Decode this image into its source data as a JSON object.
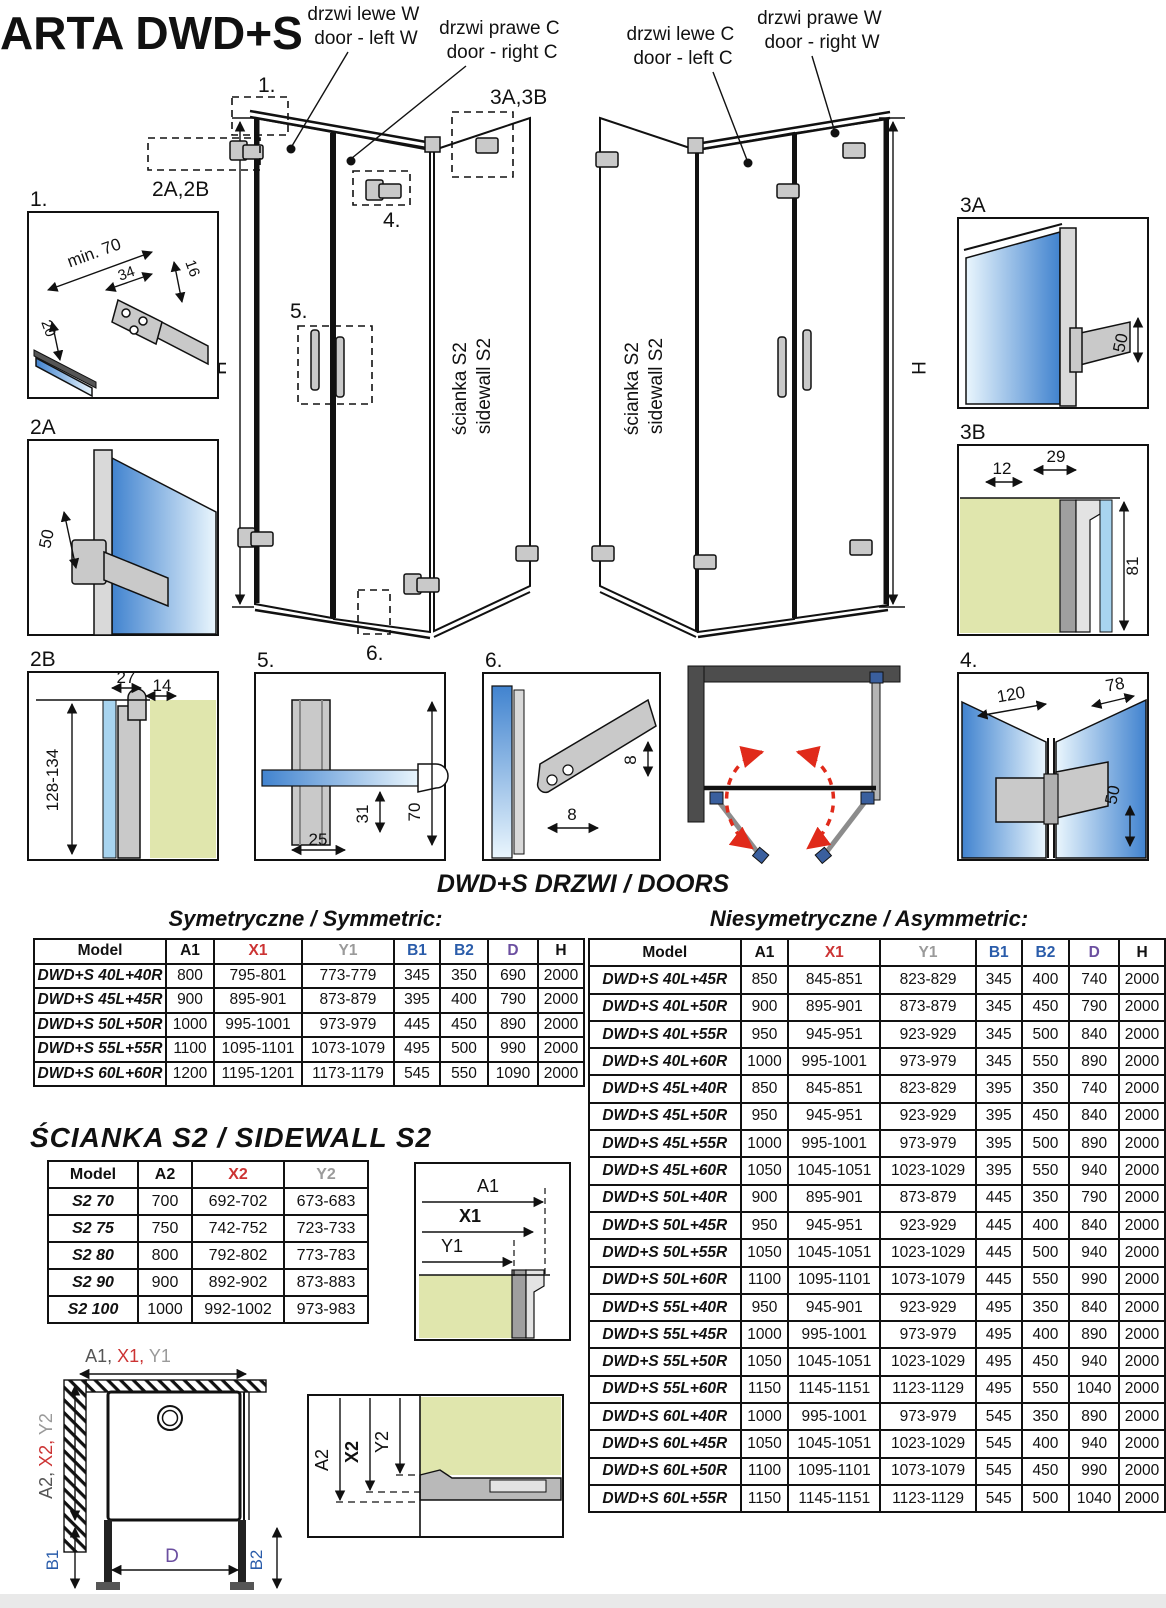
{
  "header": {
    "title": "ARTA DWD+S"
  },
  "units": {
    "left": {
      "door_l1": "drzwi lewe W",
      "door_l2": "door - left W",
      "door_r1": "drzwi prawe C",
      "door_r2": "door - right C",
      "wall1": "ścianka S2",
      "wall2": "sidewall S2",
      "h": "H"
    },
    "right": {
      "door_l1": "drzwi lewe C",
      "door_l2": "door - left C",
      "door_r1": "drzwi prawe W",
      "door_r2": "door - right W",
      "wall1": "ścianka S2",
      "wall2": "sidewall S2",
      "h": "H"
    }
  },
  "callouts": {
    "c1": "1.",
    "c2": "2A,2B",
    "c3": "3A,3B",
    "c4": "4.",
    "c5": "5.",
    "c6": "6."
  },
  "details": {
    "d1": {
      "label": "1.",
      "min70": "min. 70",
      "d34": "34",
      "d16": "16",
      "d20": "20"
    },
    "d2a": {
      "label": "2A",
      "d50": "50"
    },
    "d2b": {
      "label": "2B",
      "d27": "27",
      "d14": "14",
      "range": "128-134"
    },
    "d3a": {
      "label": "3A",
      "d50": "50"
    },
    "d3b": {
      "label": "3B",
      "d12": "12",
      "d29": "29",
      "d81": "81"
    },
    "d4": {
      "label": "4.",
      "d120": "120",
      "d78": "78",
      "d50": "50"
    },
    "d5": {
      "label": "5.",
      "d31": "31",
      "d25": "25",
      "d70": "70"
    },
    "d6": {
      "label": "6.",
      "d8a": "8",
      "d8b": "8"
    }
  },
  "tables": {
    "doors_title": "DWD+S DRZWI / DOORS",
    "symmetric": {
      "title": "Symetryczne / Symmetric:",
      "headers": [
        "Model",
        "A1",
        "X1",
        "Y1",
        "B1",
        "B2",
        "D",
        "H"
      ],
      "header_colors": [
        "#111",
        "#111",
        "#cc3333",
        "#9a9a9a",
        "#2a5caa",
        "#2a5caa",
        "#6b4fa0",
        "#111"
      ],
      "rows": [
        [
          "DWD+S 40L+40R",
          "800",
          "795-801",
          "773-779",
          "345",
          "350",
          "690",
          "2000"
        ],
        [
          "DWD+S 45L+45R",
          "900",
          "895-901",
          "873-879",
          "395",
          "400",
          "790",
          "2000"
        ],
        [
          "DWD+S 50L+50R",
          "1000",
          "995-1001",
          "973-979",
          "445",
          "450",
          "890",
          "2000"
        ],
        [
          "DWD+S 55L+55R",
          "1100",
          "1095-1101",
          "1073-1079",
          "495",
          "500",
          "990",
          "2000"
        ],
        [
          "DWD+S 60L+60R",
          "1200",
          "1195-1201",
          "1173-1179",
          "545",
          "550",
          "1090",
          "2000"
        ]
      ]
    },
    "asymmetric": {
      "title": "Niesymetryczne / Asymmetric:",
      "headers": [
        "Model",
        "A1",
        "X1",
        "Y1",
        "B1",
        "B2",
        "D",
        "H"
      ],
      "header_colors": [
        "#111",
        "#111",
        "#cc3333",
        "#9a9a9a",
        "#2a5caa",
        "#2a5caa",
        "#6b4fa0",
        "#111"
      ],
      "rows": [
        [
          "DWD+S 40L+45R",
          "850",
          "845-851",
          "823-829",
          "345",
          "400",
          "740",
          "2000"
        ],
        [
          "DWD+S 40L+50R",
          "900",
          "895-901",
          "873-879",
          "345",
          "450",
          "790",
          "2000"
        ],
        [
          "DWD+S 40L+55R",
          "950",
          "945-951",
          "923-929",
          "345",
          "500",
          "840",
          "2000"
        ],
        [
          "DWD+S 40L+60R",
          "1000",
          "995-1001",
          "973-979",
          "345",
          "550",
          "890",
          "2000"
        ],
        [
          "DWD+S 45L+40R",
          "850",
          "845-851",
          "823-829",
          "395",
          "350",
          "740",
          "2000"
        ],
        [
          "DWD+S 45L+50R",
          "950",
          "945-951",
          "923-929",
          "395",
          "450",
          "840",
          "2000"
        ],
        [
          "DWD+S 45L+55R",
          "1000",
          "995-1001",
          "973-979",
          "395",
          "500",
          "890",
          "2000"
        ],
        [
          "DWD+S 45L+60R",
          "1050",
          "1045-1051",
          "1023-1029",
          "395",
          "550",
          "940",
          "2000"
        ],
        [
          "DWD+S 50L+40R",
          "900",
          "895-901",
          "873-879",
          "445",
          "350",
          "790",
          "2000"
        ],
        [
          "DWD+S 50L+45R",
          "950",
          "945-951",
          "923-929",
          "445",
          "400",
          "840",
          "2000"
        ],
        [
          "DWD+S 50L+55R",
          "1050",
          "1045-1051",
          "1023-1029",
          "445",
          "500",
          "940",
          "2000"
        ],
        [
          "DWD+S 50L+60R",
          "1100",
          "1095-1101",
          "1073-1079",
          "445",
          "550",
          "990",
          "2000"
        ],
        [
          "DWD+S 55L+40R",
          "950",
          "945-901",
          "923-929",
          "495",
          "350",
          "840",
          "2000"
        ],
        [
          "DWD+S 55L+45R",
          "1000",
          "995-1001",
          "973-979",
          "495",
          "400",
          "890",
          "2000"
        ],
        [
          "DWD+S 55L+50R",
          "1050",
          "1045-1051",
          "1023-1029",
          "495",
          "450",
          "940",
          "2000"
        ],
        [
          "DWD+S 55L+60R",
          "1150",
          "1145-1151",
          "1123-1129",
          "495",
          "550",
          "1040",
          "2000"
        ],
        [
          "DWD+S 60L+40R",
          "1000",
          "995-1001",
          "973-979",
          "545",
          "350",
          "890",
          "2000"
        ],
        [
          "DWD+S 60L+45R",
          "1050",
          "1045-1051",
          "1023-1029",
          "545",
          "400",
          "940",
          "2000"
        ],
        [
          "DWD+S 60L+50R",
          "1100",
          "1095-1101",
          "1073-1079",
          "545",
          "450",
          "990",
          "2000"
        ],
        [
          "DWD+S 60L+55R",
          "1150",
          "1145-1151",
          "1123-1129",
          "545",
          "500",
          "1040",
          "2000"
        ]
      ]
    },
    "sidewall": {
      "title": "ŚCIANKA S2 / SIDEWALL S2",
      "headers": [
        "Model",
        "A2",
        "X2",
        "Y2"
      ],
      "header_colors": [
        "#111",
        "#111",
        "#cc3333",
        "#9a9a9a"
      ],
      "rows": [
        [
          "S2 70",
          "700",
          "692-702",
          "673-683"
        ],
        [
          "S2 75",
          "750",
          "742-752",
          "723-733"
        ],
        [
          "S2 80",
          "800",
          "792-802",
          "773-783"
        ],
        [
          "S2 90",
          "900",
          "892-902",
          "873-883"
        ],
        [
          "S2 100",
          "1000",
          "992-1002",
          "973-983"
        ]
      ]
    }
  },
  "footer_diagrams": {
    "a1x1y1": {
      "a1": "A1",
      "x1": "X1",
      "y1": "Y1"
    },
    "plan": {
      "top_a": "A1,",
      "top_x": " X1,",
      "top_y": " Y1",
      "left_a": "A2,",
      "left_x": " X2,",
      "left_y": " Y2",
      "b1": "B1",
      "b2": "B2",
      "d": "D"
    },
    "section": {
      "a2": "A2",
      "x2": "X2",
      "y2": "Y2"
    }
  },
  "colors": {
    "x_dim": "#cc3333",
    "y_dim": "#9a9a9a",
    "b_dim": "#2a5caa",
    "d_dim": "#6b4fa0",
    "glass_blue": "#4183cf",
    "wall_green": "#e0e6ad",
    "swing_arrow_red": "#e02a1a"
  }
}
